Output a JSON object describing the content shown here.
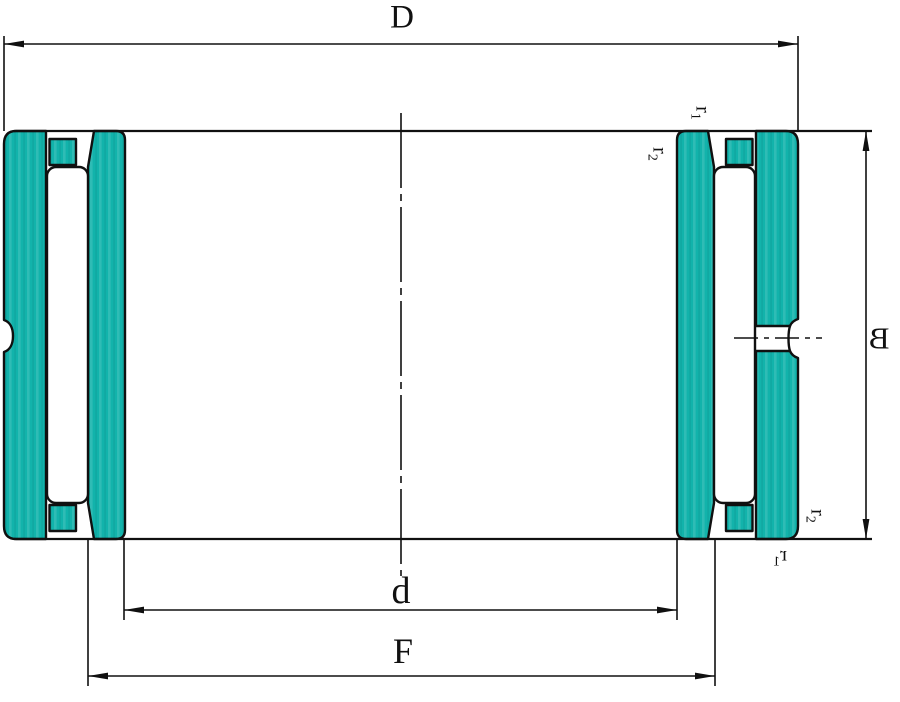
{
  "drawing": {
    "kind": "needle-roller-bearing-cross-section",
    "labels": {
      "outer_diameter": "D",
      "bore_diameter": "d",
      "width": "B",
      "raceway_diameter": "F",
      "r_base": "r",
      "r1_subscript": "1",
      "r2_subscript": "2"
    }
  },
  "colors": {
    "part_fill": "#12b3ab",
    "outline": "#101010",
    "background": "#ffffff"
  }
}
